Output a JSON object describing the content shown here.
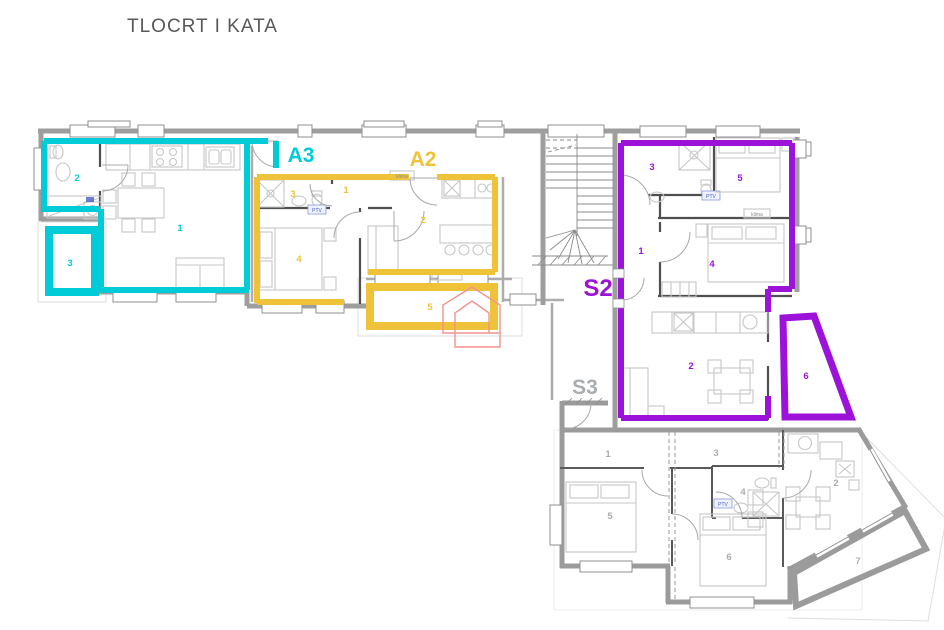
{
  "title": {
    "text": "TLOCRT I KATA"
  },
  "units": [
    {
      "id": "A3",
      "label": "A3",
      "color": "#00ccd8",
      "label_x": 301,
      "label_y": 162,
      "label_size": 21,
      "rooms": [
        {
          "n": "1",
          "x": 180,
          "y": 231
        },
        {
          "n": "2",
          "x": 77,
          "y": 181
        },
        {
          "n": "3",
          "x": 70,
          "y": 266
        }
      ]
    },
    {
      "id": "A2",
      "label": "A2",
      "color": "#eec33a",
      "label_x": 423,
      "label_y": 166,
      "label_size": 21,
      "rooms": [
        {
          "n": "1",
          "x": 346,
          "y": 193
        },
        {
          "n": "2",
          "x": 423,
          "y": 223
        },
        {
          "n": "3",
          "x": 293,
          "y": 197
        },
        {
          "n": "4",
          "x": 299,
          "y": 262
        },
        {
          "n": "5",
          "x": 430,
          "y": 310
        }
      ]
    },
    {
      "id": "S2",
      "label": "S2",
      "color": "#9c12d9",
      "label_x": 598,
      "label_y": 296,
      "label_size": 24,
      "rooms": [
        {
          "n": "1",
          "x": 641,
          "y": 254
        },
        {
          "n": "2",
          "x": 691,
          "y": 369
        },
        {
          "n": "3",
          "x": 652,
          "y": 170
        },
        {
          "n": "4",
          "x": 712,
          "y": 267
        },
        {
          "n": "5",
          "x": 740,
          "y": 181
        },
        {
          "n": "6",
          "x": 806,
          "y": 379
        }
      ]
    },
    {
      "id": "S3",
      "label": "S3",
      "color": "#a9adb0",
      "label_x": 585,
      "label_y": 394,
      "label_size": 21,
      "rooms": [
        {
          "n": "1",
          "x": 608,
          "y": 457
        },
        {
          "n": "2",
          "x": 836,
          "y": 486
        },
        {
          "n": "3",
          "x": 716,
          "y": 456
        },
        {
          "n": "4",
          "x": 743,
          "y": 495
        },
        {
          "n": "5",
          "x": 610,
          "y": 519
        },
        {
          "n": "6",
          "x": 729,
          "y": 560
        },
        {
          "n": "7",
          "x": 858,
          "y": 564
        }
      ]
    }
  ],
  "annotations": [
    {
      "text": "klima",
      "x": 402,
      "y": 178,
      "color": "#8a8a8a",
      "size": 5
    },
    {
      "text": "klima",
      "x": 757,
      "y": 216,
      "color": "#8a8a8a",
      "size": 5
    },
    {
      "text": "PTV",
      "x": 317,
      "y": 212,
      "color": "#3a55c4",
      "size": 5
    },
    {
      "text": "PTV",
      "x": 711,
      "y": 198,
      "color": "#3a55c4",
      "size": 5
    },
    {
      "text": "PTV",
      "x": 723,
      "y": 506,
      "color": "#3a55c4",
      "size": 5
    }
  ],
  "colors": {
    "unit_a3": "#00ccd8",
    "unit_a2": "#eec33a",
    "unit_s2": "#9c12d9",
    "unit_s3_outline": "#9b9b9b",
    "unit_s3_label": "#a9adb0",
    "title": "#58585a",
    "logo": "#f2948d",
    "ptv": "#3a55c4"
  }
}
